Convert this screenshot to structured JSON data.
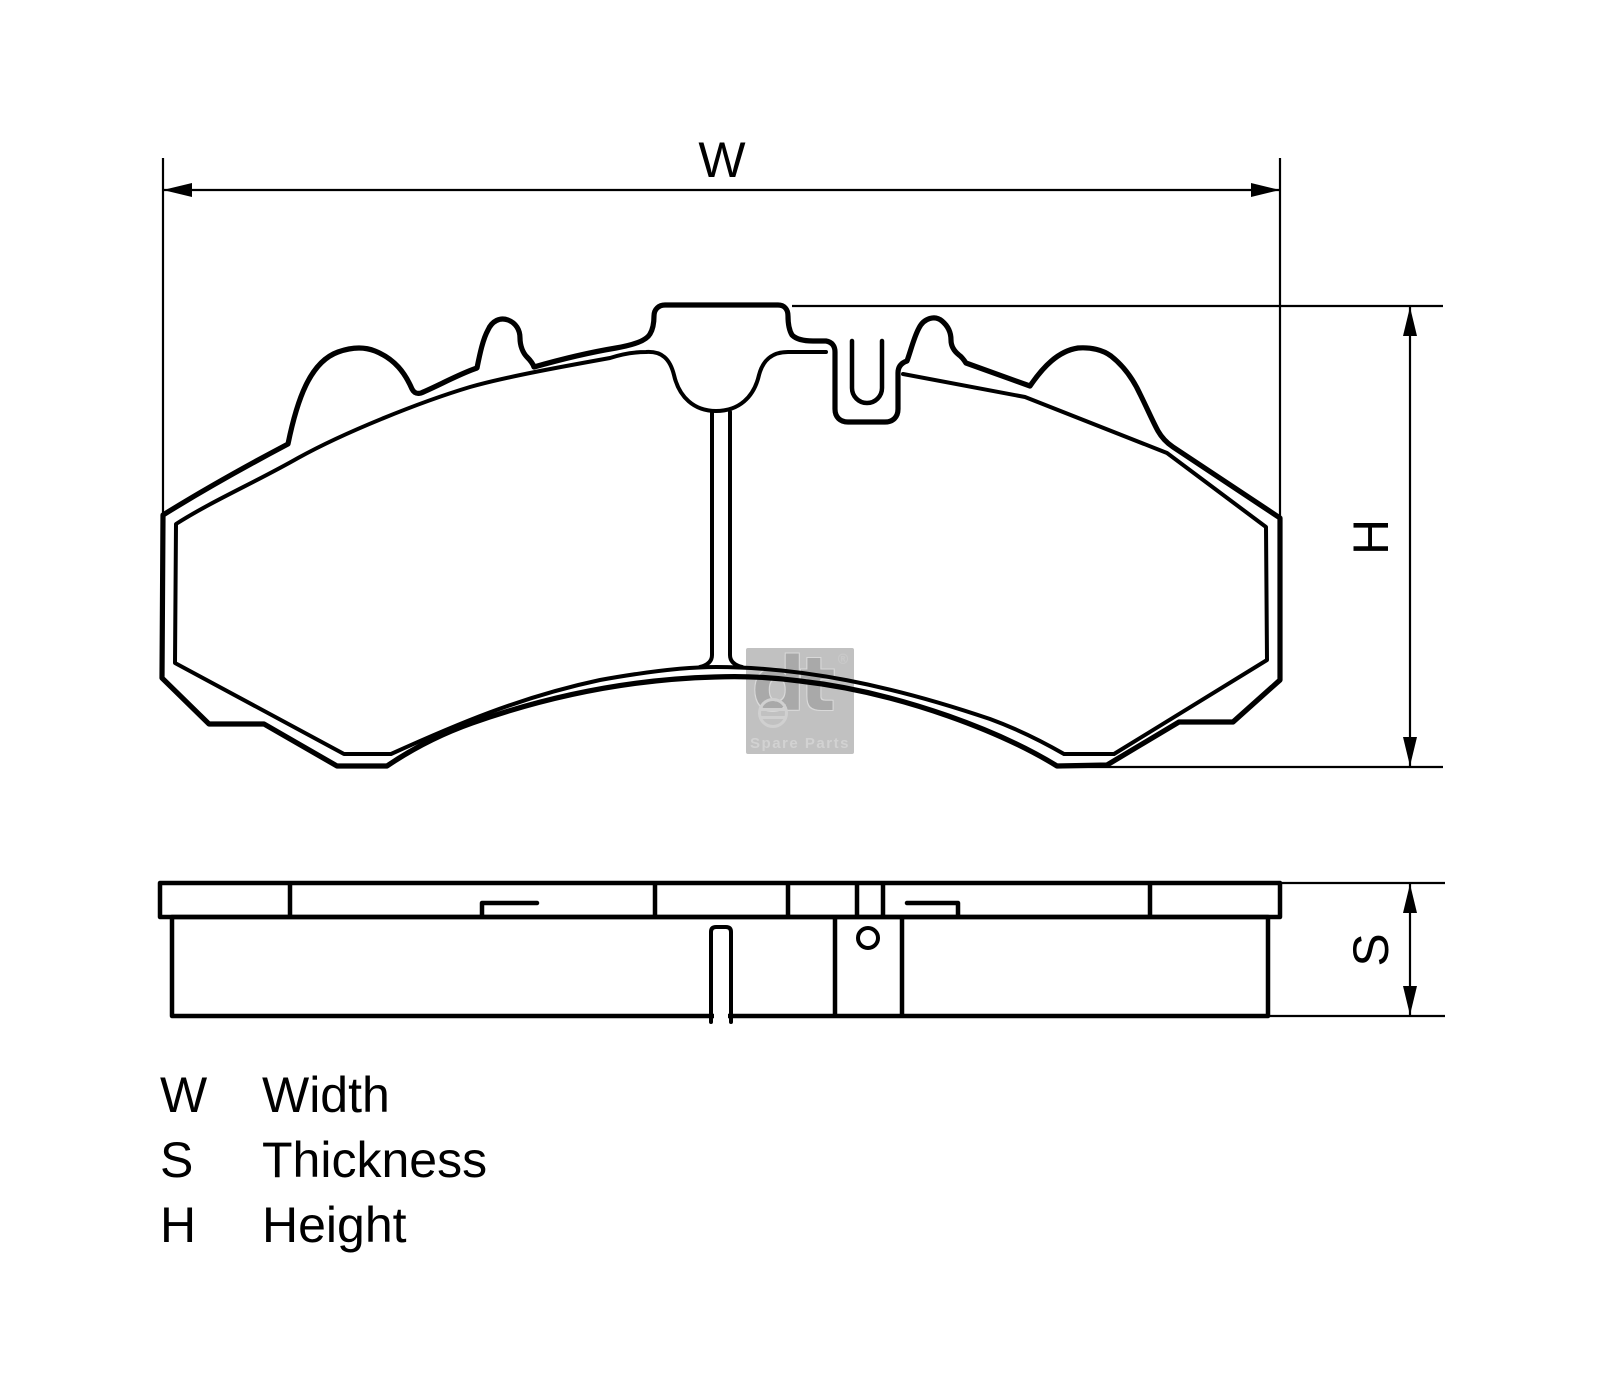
{
  "drawing": {
    "type": "technical-dimension-drawing",
    "views": [
      "front-view-brake-pad",
      "side-profile-brake-pad"
    ],
    "dimension_labels": {
      "width": "W",
      "height": "H",
      "thickness": "S"
    },
    "legend": {
      "rows": [
        {
          "symbol": "W",
          "term": "Width"
        },
        {
          "symbol": "S",
          "term": "Thickness"
        },
        {
          "symbol": "H",
          "term": "Height"
        }
      ]
    },
    "watermark": {
      "brand": "dt",
      "registered": "®",
      "subtitle": "Spare Parts"
    },
    "colors": {
      "line": "#000000",
      "background": "#ffffff",
      "watermark_bg": "#c1c1c1",
      "watermark_logo": "#a9a9a9",
      "watermark_subtitle": "#d2d2d2"
    }
  }
}
